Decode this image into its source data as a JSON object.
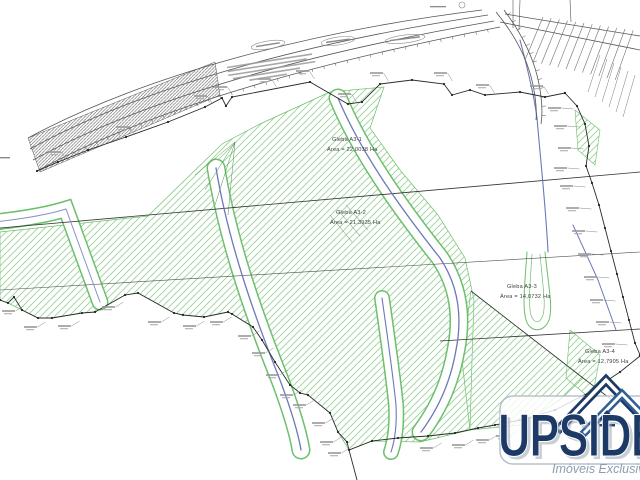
{
  "map": {
    "type": "cadastral-survey-plan",
    "glebas": [
      {
        "name": "Gleba A3-1",
        "area": "Área = 22,0038 Ha"
      },
      {
        "name": "Gleba A3-2",
        "area": "Área = 21,3935 Ha"
      },
      {
        "name": "Gleba A3-3",
        "area": "Área = 14,0732 Ha"
      },
      {
        "name": "Gleba A3-4",
        "area": "Área = 12,7905 Ha"
      }
    ]
  },
  "logo": {
    "brand": "UPSIDE",
    "tagline": "Imóveis Exclusivos",
    "navy": "#1d3a66",
    "blue": "#2f6095",
    "gray_blue": "#8d9db1"
  },
  "colors": {
    "green_hatch": "#9cd39c",
    "green_edge": "#6cbf6c",
    "stream_blue": "#6b79b8",
    "boundary": "#2b2b2b"
  }
}
